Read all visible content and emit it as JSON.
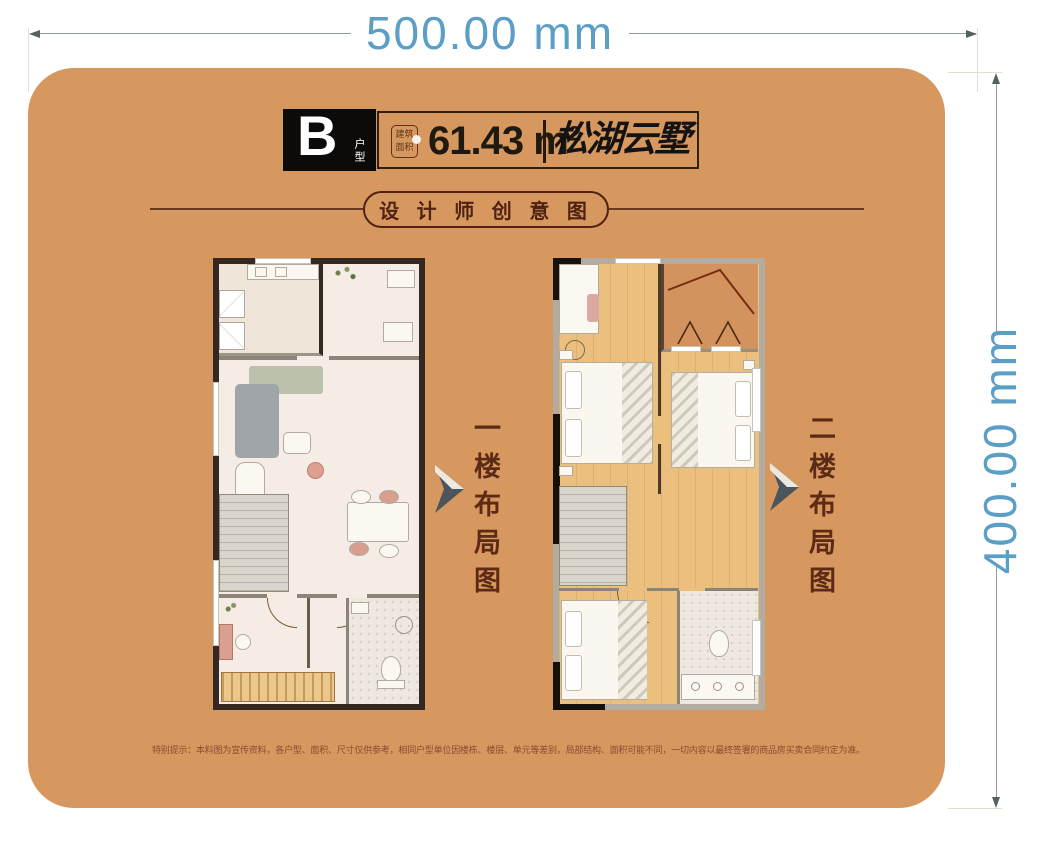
{
  "dimensions": {
    "width_label": "500.00 mm",
    "height_label": "400.00 mm"
  },
  "header": {
    "type_letter": "B",
    "type_suffix": "户型",
    "stamp_line1": "建筑",
    "stamp_line2": "面积",
    "area": "61.43 m²",
    "brand": "松湖云墅"
  },
  "subtitle": "设 计 师 创 意 图",
  "plans": [
    {
      "label": "一楼布局图"
    },
    {
      "label": "二楼布局图"
    }
  ],
  "disclaimer": "特别提示：本料图为宣传资料，各户型、面积、尺寸仅供参考，相同户型单位因楼栋、楼层、单元等差别，局部结构、面积可能不同，一切内容以最终签署的商品房买卖合同约定为准。",
  "colors": {
    "card": "#D6985F",
    "dimension_text": "#5B9EC6",
    "accent_brown": "#4F2212",
    "wood_floor": "#EBC07E"
  }
}
